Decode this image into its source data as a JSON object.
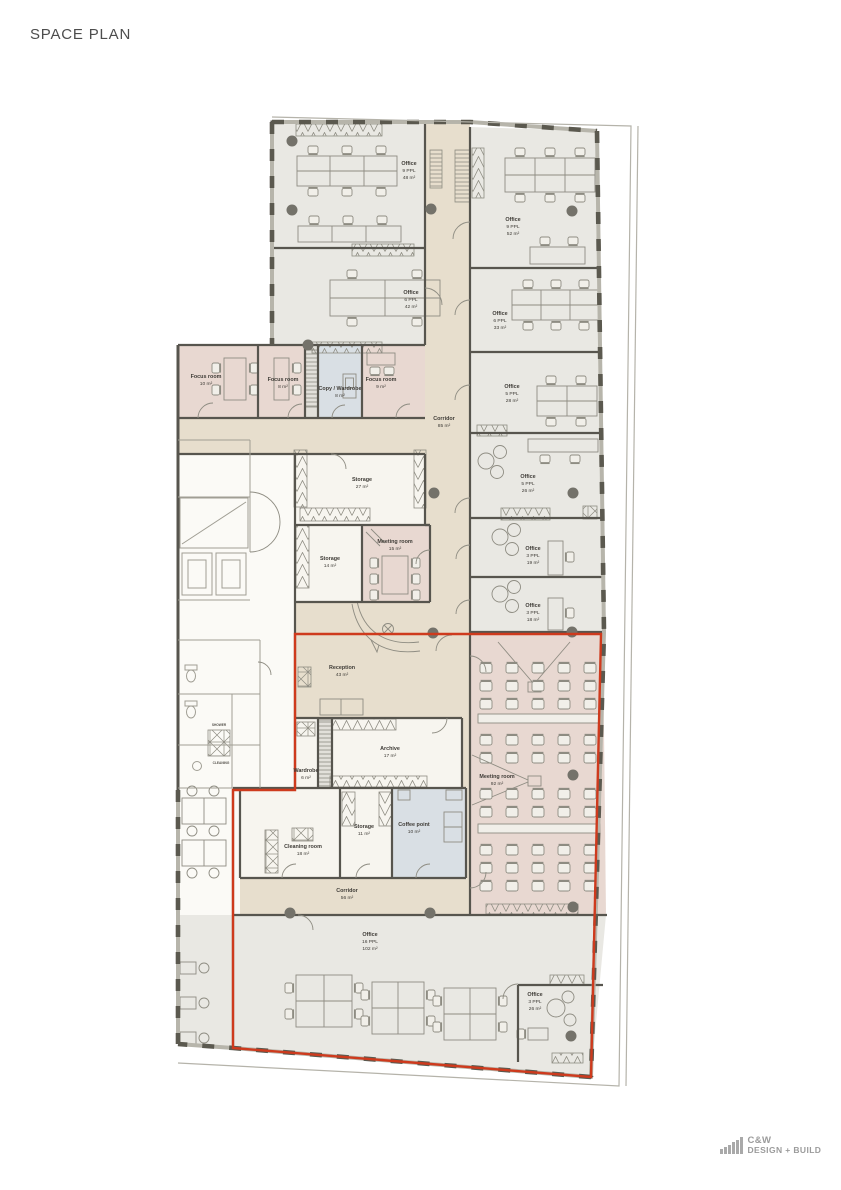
{
  "page": {
    "title": "SPACE PLAN"
  },
  "logo": {
    "name": "C&W",
    "tagline": "DESIGN + BUILD"
  },
  "plan": {
    "colors": {
      "circulation": "#e7decd",
      "office": "#e9e8e3",
      "meeting": "#e8d8d1",
      "utility": "#d9dfe4",
      "storage": "#f7f5ef",
      "core": "#fbfaf6",
      "shaft": "#e2e0da",
      "outline": "#ce3a1d",
      "wall": "#57554e"
    },
    "rooms": {
      "office_a": {
        "name": "Office",
        "capacity": "9 PPL",
        "area": "48 m²"
      },
      "office_b": {
        "name": "Office",
        "capacity": "6 PPL",
        "area": "42 m²"
      },
      "office_c": {
        "name": "Office",
        "capacity": "9 PPL",
        "area": "52 m²"
      },
      "office_d": {
        "name": "Office",
        "capacity": "6 PPL",
        "area": "33 m²"
      },
      "office_e": {
        "name": "Office",
        "capacity": "5 PPL",
        "area": "28 m²"
      },
      "office_f": {
        "name": "Office",
        "capacity": "5 PPL",
        "area": "26 m²"
      },
      "office_g": {
        "name": "Office",
        "capacity": "3 PPL",
        "area": "19 m²"
      },
      "office_h": {
        "name": "Office",
        "capacity": "3 PPL",
        "area": "18 m²"
      },
      "office_i": {
        "name": "Office",
        "capacity": "16 PPL",
        "area": "102 m²"
      },
      "office_j": {
        "name": "Office",
        "capacity": "3 PPL",
        "area": "26 m²"
      },
      "focus_a": {
        "name": "Focus room",
        "area": "10 m²"
      },
      "focus_b": {
        "name": "Focus room",
        "area": "8 m²"
      },
      "copy": {
        "name": "Copy / Wardrobe",
        "area": "8 m²"
      },
      "focus_c": {
        "name": "Focus room",
        "area": "9 m²"
      },
      "corridor_a": {
        "name": "Corridor",
        "area": "85 m²"
      },
      "storage_a": {
        "name": "Storage",
        "area": "27 m²"
      },
      "storage_b": {
        "name": "Storage",
        "area": "14 m²"
      },
      "meeting_a": {
        "name": "Meeting room",
        "area": "15 m²"
      },
      "reception": {
        "name": "Reception",
        "area": "43 m²"
      },
      "archive": {
        "name": "Archive",
        "area": "17 m²"
      },
      "wardrobe": {
        "name": "Wardrobe",
        "area": "6 m²"
      },
      "storage_c": {
        "name": "Storage",
        "area": "11 m²"
      },
      "coffee": {
        "name": "Coffee point",
        "area": "10 m²"
      },
      "cleaning": {
        "name": "Cleaning room",
        "area": "18 m²"
      },
      "corridor_b": {
        "name": "Corridor",
        "area": "56 m²"
      },
      "meeting_b": {
        "name": "Meeting room",
        "area": "92 m²"
      }
    },
    "core": {
      "shower": "SHOWER",
      "cleaning": "CLEANING"
    }
  }
}
